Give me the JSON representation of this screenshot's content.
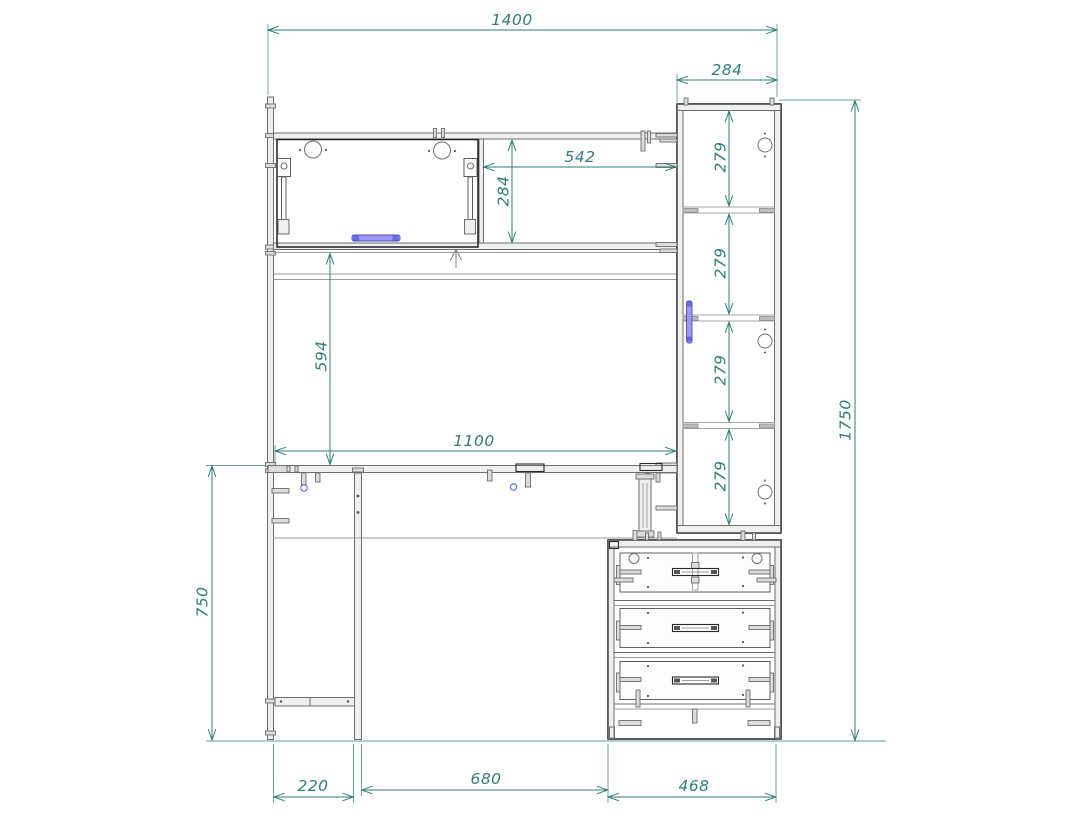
{
  "drawing": {
    "type": "furniture_assembly_front_view",
    "dimensions": {
      "overall_width": "1400",
      "side_cabinet_width": "284",
      "shelf_opening_width": "542",
      "shelf_opening_height": "284",
      "cabinet_compartments": [
        "279",
        "279",
        "279",
        "279"
      ],
      "worktop_to_shelf_clearance": "594",
      "worktop_width": "1100",
      "worktop_height": "750",
      "overall_height": "1750",
      "left_leg_depth": "220",
      "knee_space_width": "680",
      "drawer_unit_width": "468"
    },
    "colors": {
      "dimension_lines": "#2e7d7b",
      "outline_dark": "#1f1f1f",
      "outline_gray": "#6e6e6e",
      "panel_fill": "#efefef",
      "handle_blue": "#9a9af0",
      "fitting_blue": "#4a6ce0",
      "background": "#ffffff"
    }
  }
}
